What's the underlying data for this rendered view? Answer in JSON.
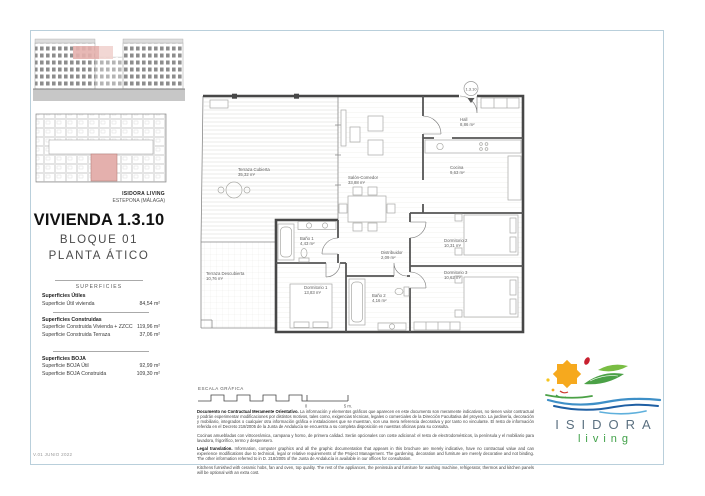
{
  "page": {
    "version": "V.01 JUNIO 2022"
  },
  "project": {
    "brand_line1": "ISIDORA LIVING",
    "brand_line2": "ESTEPONA (MÁLAGA)"
  },
  "unit": {
    "title": "VIVIENDA 1.3.10",
    "block": "BLOQUE 01",
    "floor": "PLANTA ÁTICO",
    "badge": "1.3.10"
  },
  "surfaces": {
    "header": "SUPERFICIES",
    "sections": [
      {
        "title": "Superficies Útiles",
        "rows": [
          {
            "label": "Superficie Útil vivienda",
            "value": "84,54 m²"
          }
        ]
      },
      {
        "title": "Superficies Construidas",
        "rows": [
          {
            "label": "Superficie Construida Vivienda + ZZCC",
            "value": "119,96 m²"
          },
          {
            "label": "Superficie Construida Terraza",
            "value": "37,06 m²"
          }
        ]
      },
      {
        "title": "Superficies BOJA",
        "rows": [
          {
            "label": "Superficie BOJA Útil",
            "value": "92,99 m²"
          },
          {
            "label": "Superficie BOJA Construida",
            "value": "109,30 m²"
          }
        ]
      }
    ]
  },
  "plan": {
    "rooms": [
      {
        "name": "Terraza Cubierta",
        "area": "35,32 m²"
      },
      {
        "name": "Terraza Descubierta",
        "area": "10,76 m²"
      },
      {
        "name": "Salón-Comedor",
        "area": "33,88 m²"
      },
      {
        "name": "Cocina",
        "area": "9,63 m²"
      },
      {
        "name": "Hall",
        "area": "8,86 m²"
      },
      {
        "name": "Baño 1",
        "area": "4,43 m²"
      },
      {
        "name": "Dormitorio 1",
        "area": "13,83 m²"
      },
      {
        "name": "Distribuidor",
        "area": "2,09 m²"
      },
      {
        "name": "Baño 2",
        "area": "4,16 m²"
      },
      {
        "name": "Dormitorio 2",
        "area": "10,31 m²"
      },
      {
        "name": "Dormitorio 3",
        "area": "10,62 m²"
      }
    ]
  },
  "scale": {
    "label": "ESCALA GRÁFICA",
    "zero": "0",
    "max": "5 m."
  },
  "legal": {
    "p1_lead": "Documento no Contractual Meramente Orientativo.",
    "p1_text": " La información y elementos gráficos que aparecen en este documento son meramente indicativos, no tienen valor contractual y podrán experimentar modificaciones por distintos motivos, tales como, exigencias técnicas, legales o comerciales de la Dirección Facultativa del proyecto. La jardinería, decoración y mobiliario, integrados o cualquier otra información gráfica e instalaciones que se muestran, son una mera referencia decorativa y por tanto no vinculante. El resto de información referida en el Decreto 218/2005 de la Junta de Andalucía se encuentra a su completa disposición en nuestras oficinas para su consulta.",
    "p2_text": "Cocinas amuebladas con vitrocerámica, campana y horno, de primera calidad. Serán opcionales con coste adicional: el resto de electrodomésticos, la península y el mobiliario para lavadora, frigorífico, termo y despensero.",
    "p3_lead": "Legal translation.",
    "p3_text": " Information, computer graphics and all the graphic documentation that appears in this brochure are merely indicative, have no contractual value and can experience modifications due to technical, legal or relative requirements of the Project Management. The gardening, decoration and furniture are merely decorative and not binding. The other information referred to in D. 218/2005 of the Junta de Andalucía is available in our offices for consultation.",
    "p4_text": "Kitchens furnished with ceramic hobs, fan and oven, top quality. The rest of the appliances, the peninsula and furniture for washing machine, refrigerator, thermos and kitchen panels will be optional with an extra cost."
  },
  "logo": {
    "name": "ISIDORA",
    "tagline": "living"
  },
  "colors": {
    "highlight_pink": "#e4b0ad",
    "frame_blue": "#b9cfdb",
    "wall_grey": "#474747",
    "logo_orange": "#f6a91e",
    "logo_red": "#c8202f",
    "logo_green": "#4ba146",
    "logo_blue": "#3e8fc7",
    "logo_text_grey": "#5b7080"
  }
}
